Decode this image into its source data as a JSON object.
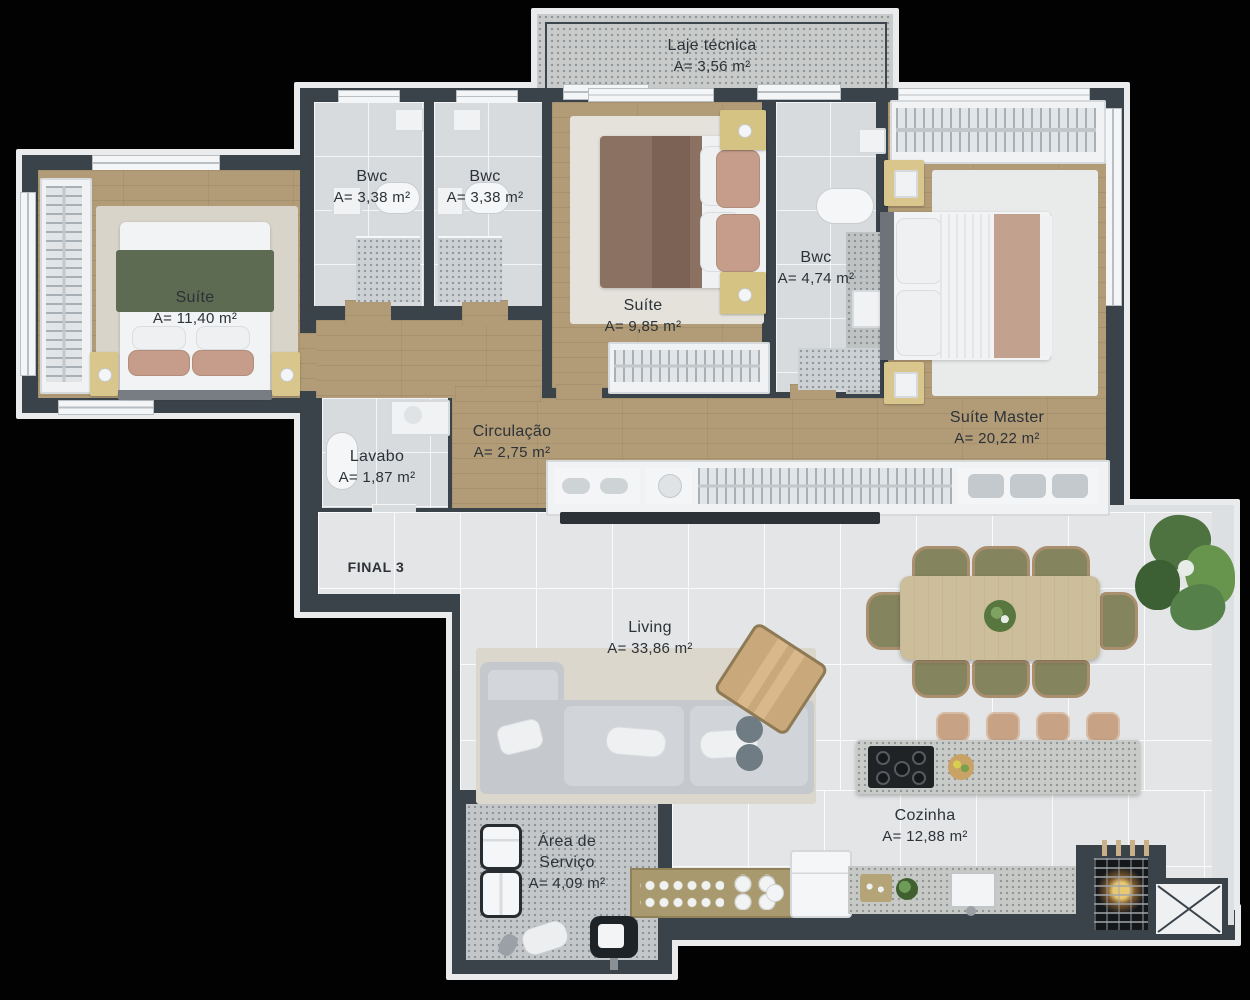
{
  "unit": {
    "final_label": "FINAL 3"
  },
  "rooms": {
    "laje": {
      "name": "Laje técnica",
      "area": "A= 3,56 m²"
    },
    "bwc1": {
      "name": "Bwc",
      "area": "A= 3,38 m²"
    },
    "bwc2": {
      "name": "Bwc",
      "area": "A= 3,38 m²"
    },
    "suite1": {
      "name": "Suíte",
      "area": "A= 11,40 m²"
    },
    "suite2": {
      "name": "Suíte",
      "area": "A= 9,85 m²"
    },
    "bwc3": {
      "name": "Bwc",
      "area": "A= 4,74 m²"
    },
    "suite_master": {
      "name": "Suíte Master",
      "area": "A= 20,22 m²"
    },
    "circulacao": {
      "name": "Circulação",
      "area": "A= 2,75 m²"
    },
    "lavabo": {
      "name": "Lavabo",
      "area": "A= 1,87 m²"
    },
    "living": {
      "name": "Living",
      "area": "A= 33,86 m²"
    },
    "cozinha": {
      "name": "Cozinha",
      "area": "A= 12,88 m²"
    },
    "area_servico": {
      "name_line1": "Área de",
      "name_line2": "Serviço",
      "area": "A= 4,09 m²"
    }
  },
  "colors": {
    "wall": "#3a424a",
    "wood_floor": "#b29c77",
    "tile_floor": "#e3e5e7",
    "label_text": "#2c3237"
  }
}
